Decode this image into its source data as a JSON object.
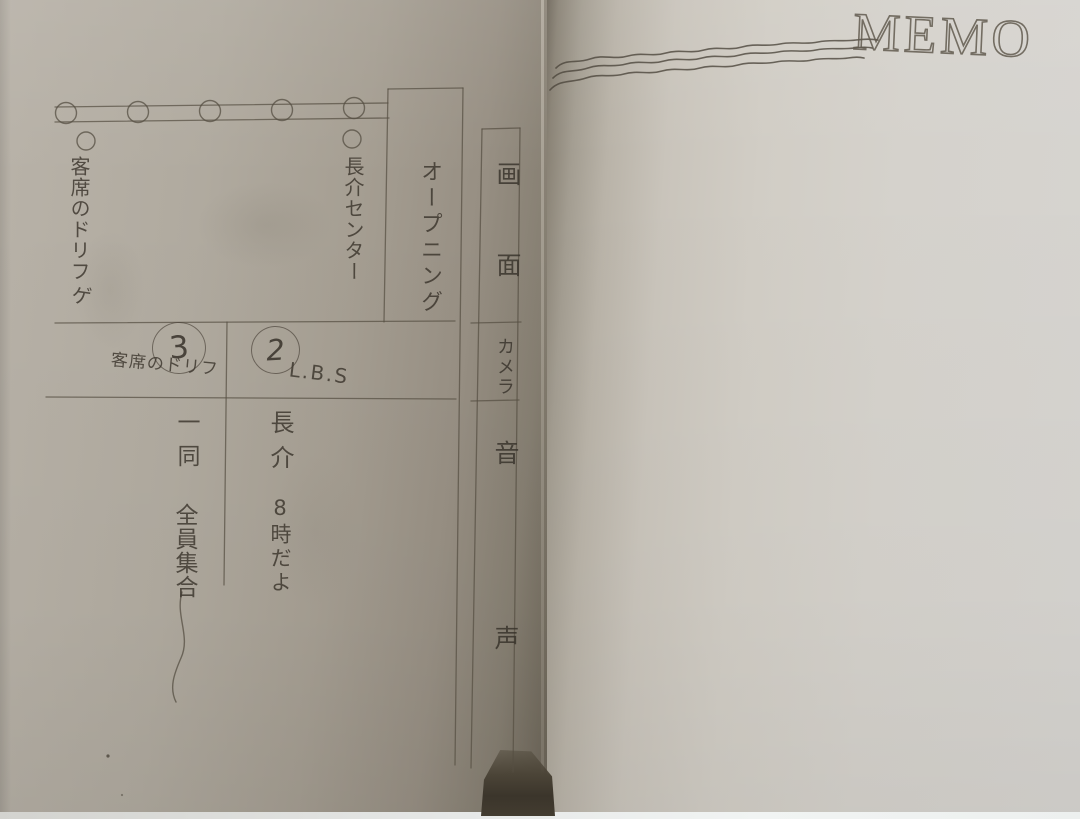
{
  "memo_page": {
    "title": "MEMO"
  },
  "script_sheet": {
    "column_headers": {
      "screen": "画面",
      "camera": "カメラ",
      "audio": "音声"
    },
    "scene_opening": {
      "title": "オープニング",
      "stage_note_left": "客席のドリフ",
      "stage_note_left_suffix": "ゲ",
      "stage_note_center": "長介センター"
    },
    "cue_rows": [
      {
        "number": "3",
        "caption": "客席のドリフ",
        "dialogue_speaker": "一同",
        "dialogue_text": "全員集合"
      },
      {
        "number": "2",
        "caption": "L.B.S",
        "dialogue_speaker": "長介",
        "dialogue_text": "8時だよ"
      }
    ]
  }
}
